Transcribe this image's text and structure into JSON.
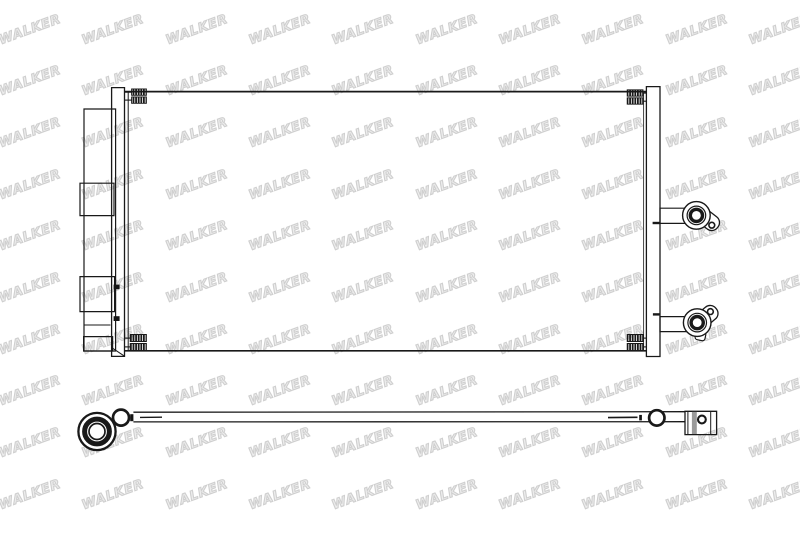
{
  "watermark": {
    "text": "WALKER",
    "fill_color": "#ededed",
    "outline_color": "#cfcfcf"
  },
  "colors": {
    "background": "#ffffff",
    "line": "#191919",
    "bracket_stripe": "#9a9a9a"
  }
}
